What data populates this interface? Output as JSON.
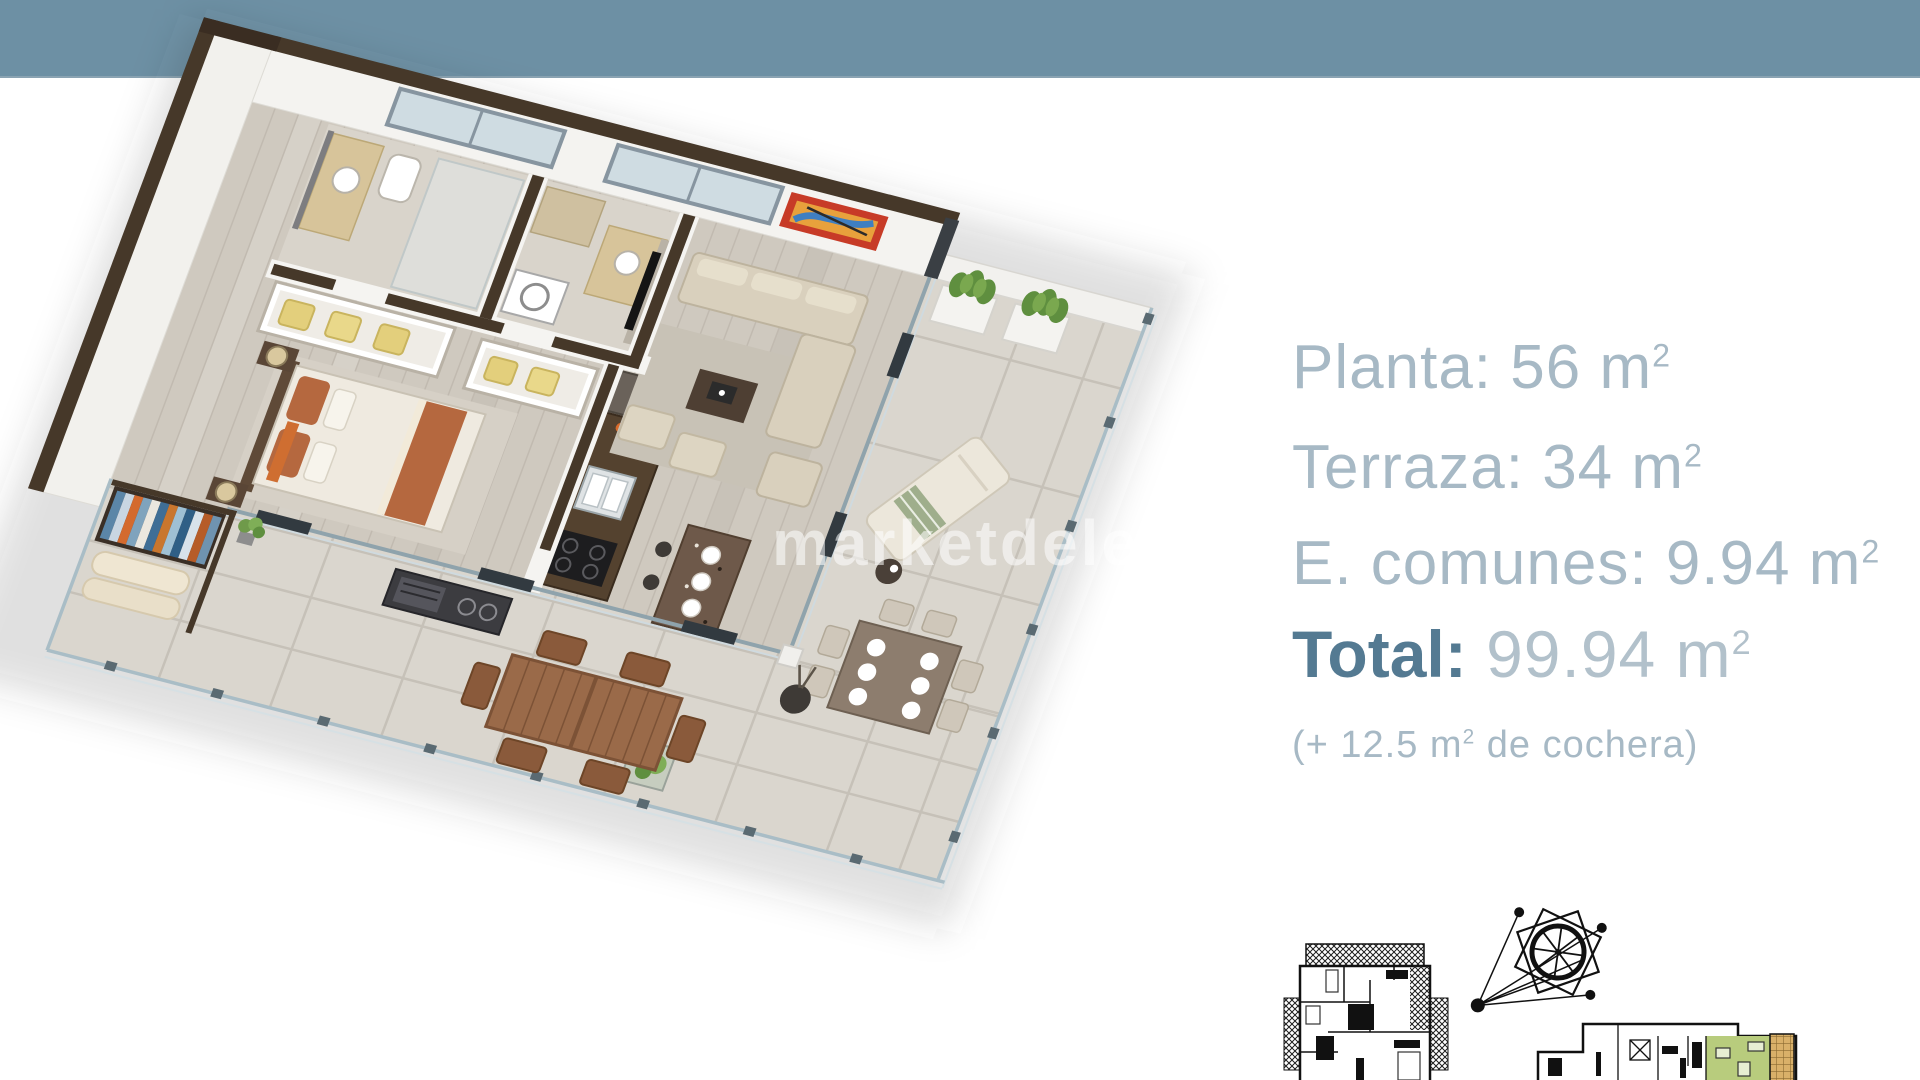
{
  "header": {
    "bar_color": "#6d90a4"
  },
  "watermark": {
    "text": "marketdelete"
  },
  "specs": {
    "lines": [
      {
        "text": "Planta: 56 m",
        "sup": "2"
      },
      {
        "text": "Terraza: 34 m",
        "sup": "2"
      },
      {
        "text": "E. comunes: 9.94 m",
        "sup": "2"
      }
    ],
    "total": {
      "label": "Total:",
      "value": " 99.94 m",
      "sup": "2"
    },
    "note": {
      "prefix": "(+ 12.5 m",
      "sup": "2",
      "suffix": " de cochera)"
    }
  },
  "colors": {
    "header_bar": "#6d90a4",
    "spec_text_light": "#a7b9c5",
    "total_accent": "#547a92",
    "wall_cap_brown": "#463829",
    "wood_floor": "#cfc9bf",
    "terrace_tile": "#dad6ce",
    "bed_accent_rust": "#b5683f",
    "painting_frame_red": "#c73b27",
    "plan_highlight_green": "#b8cc7d"
  },
  "icons": {
    "compass": "compass-rose-icon"
  }
}
